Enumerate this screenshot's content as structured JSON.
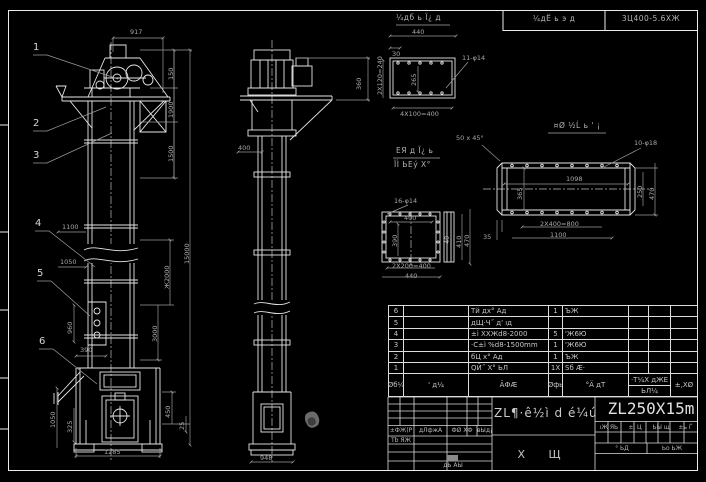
{
  "top_bar": {
    "view_label": "¼дб ь Ï¿ д",
    "cell1": "¼дЁ ь э д",
    "cell2": "3Ц400-5.6ХЖ"
  },
  "callouts": [
    "1",
    "2",
    "3",
    "4",
    "5",
    "6"
  ],
  "front": {
    "d917": "917",
    "d150": "150",
    "d1900": "1900",
    "d1500": "1500",
    "d15000": "15000",
    "d1100": "1100",
    "d1050a": "1050",
    "dx2000": "Ж2000",
    "d3000": "3000",
    "d960": "960",
    "d390": "390",
    "d1050b": "1050",
    "d325": "325",
    "d1285": "1285",
    "d450": "450",
    "d25": "25"
  },
  "side": {
    "d360": "360",
    "d400": "400",
    "d948": "948"
  },
  "detail_a": {
    "d440": "440",
    "d30": "30",
    "holes": "11-φ14",
    "d4x100": "4X100=400",
    "d2x120": "2X120=240",
    "d265": "265"
  },
  "detail_b": {
    "label1": "ЕЯ д Ï¿ ь",
    "label2": "ÏÌ ЬЕý Х°",
    "holes": "16-φ14",
    "d400": "400",
    "d390": "390",
    "d410": "410",
    "d470": "470",
    "d2x200": "2X200=400",
    "d440": "440",
    "d40": "40"
  },
  "detail_c": {
    "label": "¤Ø ½Ĺ ь ' ¡",
    "chamfer": "50 x 45°",
    "holes": "10-φ18",
    "d1098": "1098",
    "d365": "365",
    "d250": "250",
    "d470": "470",
    "d2x400": "2X400=800",
    "d1100": "1100",
    "d35": "35"
  },
  "bom": {
    "header": {
      "c1": "Øб¼",
      "c2": "' д¼",
      "c3": "ÃФÆ",
      "c4": "Øфь",
      "c5": "°Ä дТ",
      "c6a": "·Т¼Х дЖЕ",
      "c6b": "ЬЛ¼",
      "c7": "±,XØ"
    },
    "rows": [
      {
        "no": "6",
        "name": "Тй дх° Ад",
        "qty": "1",
        "mat": "ЪЖ"
      },
      {
        "no": "5",
        "name": "дЩ·Ч˝ д' ıд",
        "qty": "",
        "mat": ""
      },
      {
        "no": "4",
        "name": "±ì XХЖd8-2000",
        "qty": "5",
        "mat": "'Ж6Ю"
      },
      {
        "no": "3",
        "name": "·C±ì %d8-1500mm",
        "qty": "1",
        "mat": "'Ж6Ю"
      },
      {
        "no": "2",
        "name": "бЦ х° Ад",
        "qty": "1",
        "mat": "ЪЖ"
      },
      {
        "no": "1",
        "name": "QЙ˝ X° ЬЛ",
        "qty": "1X",
        "mat": "Ѕб Æ·"
      }
    ]
  },
  "title_block": {
    "left_row": [
      "±ФЖ(Р",
      "дЛфжА",
      "ФØ ХФ",
      "вЫд¡"
    ],
    "left_sub": "Тb ЯЖ",
    "left_bottom": "дЬ АЫ",
    "drawing_title": "ZL¶·ê½ì d é¼ú",
    "sheet_label": "Х Щ",
    "model": "ZL250X15m",
    "right_row": [
      "ıЖ ЯЬ",
      "±ì Ц",
      "ЬЫ щ",
      "±ь Ѓ"
    ],
    "right_c1": "° ЬД",
    "right_c2": "Ьо ЬЖ"
  }
}
